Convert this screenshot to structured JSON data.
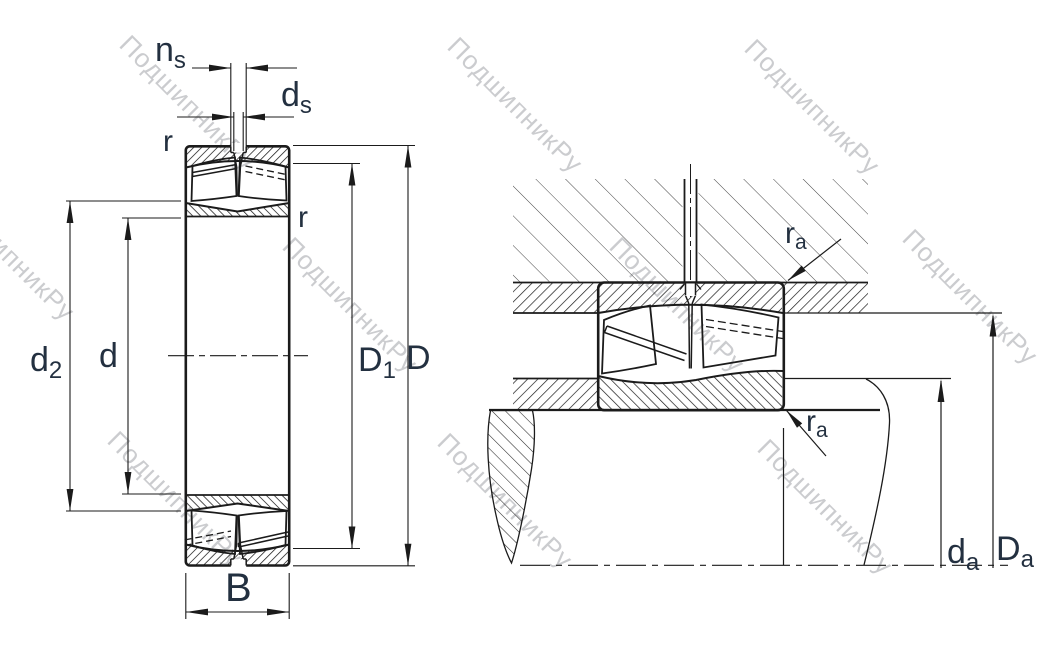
{
  "watermark": {
    "text": "ПодшипникРу",
    "color": "#c6c7ca"
  },
  "colors": {
    "background": "#ffffff",
    "line": "#1b1b1b",
    "label": "#233040"
  },
  "left_view": {
    "labels": {
      "ns": {
        "base": "n",
        "sub": "s"
      },
      "ds": {
        "base": "d",
        "sub": "s"
      },
      "r_top": "r",
      "r_right": "r",
      "d2": {
        "base": "d",
        "sub": "2"
      },
      "d": "d",
      "D1": {
        "base": "D",
        "sub": "1"
      },
      "D": "D",
      "B": "B"
    }
  },
  "right_view": {
    "labels": {
      "ra_top": {
        "base": "r",
        "sub": "a"
      },
      "ra_bottom": {
        "base": "r",
        "sub": "a"
      },
      "da": {
        "base": "d",
        "sub": "a"
      },
      "Da": {
        "base": "D",
        "sub": "a"
      }
    }
  }
}
